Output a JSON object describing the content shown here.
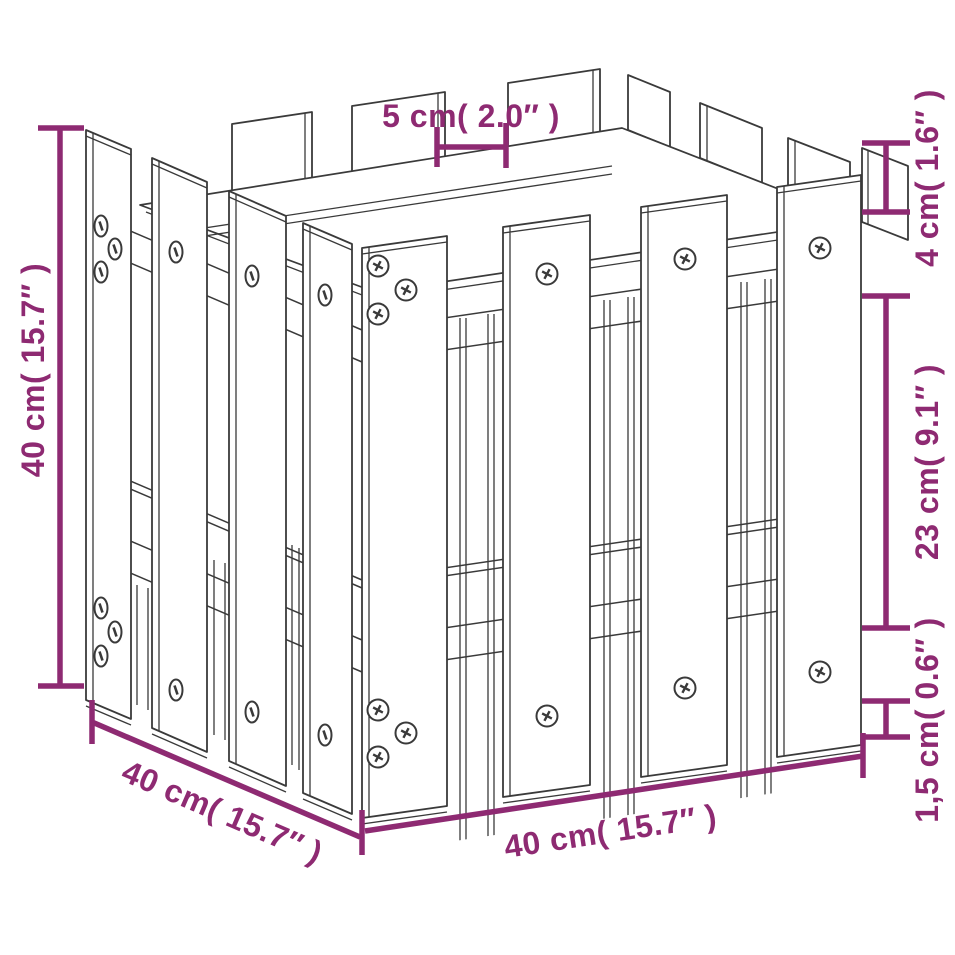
{
  "diagram": {
    "kind": "product-dimension-diagram",
    "colors": {
      "dimension": "#8e2a72",
      "outline": "#3a3a3a",
      "background": "#ffffff"
    },
    "dimensions": {
      "top_gap": "5 cm( 2.0″ )",
      "left_height": "40 cm( 15.7″ )",
      "right_picket_top": "4 cm( 1.6″ )",
      "right_board": "23 cm( 9.1″ )",
      "right_base": "1,5 cm( 0.6″ )",
      "bottom_left_depth": "40 cm( 15.7″ )",
      "bottom_width": "40 cm( 15.7″ )"
    }
  }
}
